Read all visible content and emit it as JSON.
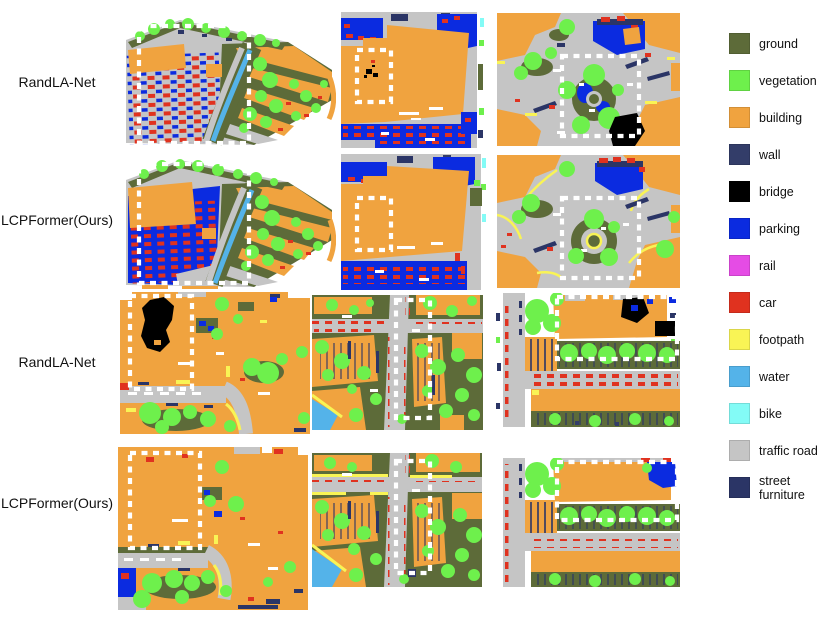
{
  "figure": {
    "rows": [
      {
        "label": "RandLA-Net"
      },
      {
        "label": "LCPFormer(Ours)"
      },
      {
        "label": "RandLA-Net"
      },
      {
        "label": "LCPFormer(Ours)"
      }
    ],
    "legend": [
      {
        "label": "ground",
        "color": "#5d6b39"
      },
      {
        "label": "vegetation",
        "color": "#6ef04c"
      },
      {
        "label": "building",
        "color": "#f0a33f"
      },
      {
        "label": "wall",
        "color": "#333d69"
      },
      {
        "label": "bridge",
        "color": "#000000"
      },
      {
        "label": "parking",
        "color": "#0b2be0"
      },
      {
        "label": "rail",
        "color": "#e54ce5"
      },
      {
        "label": "car",
        "color": "#e0321f"
      },
      {
        "label": "footpath",
        "color": "#f9f455"
      },
      {
        "label": "water",
        "color": "#54b3e9"
      },
      {
        "label": "bike",
        "color": "#83fbf6"
      },
      {
        "label": "traffic road",
        "color": "#c5c5c5"
      },
      {
        "label": "street furniture",
        "color": "#2b3566"
      }
    ],
    "highlight_color": "#ffffff"
  }
}
